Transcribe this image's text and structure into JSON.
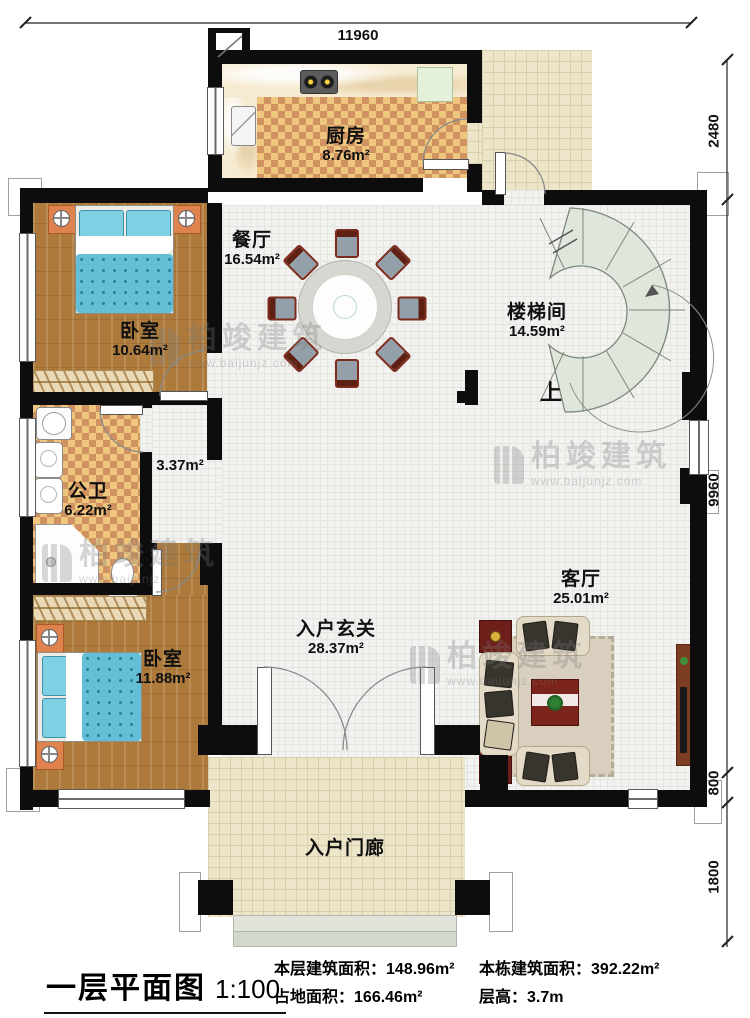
{
  "dimensions": {
    "top": "11960",
    "right": [
      {
        "label": "2480"
      },
      {
        "label": "9960"
      },
      {
        "label": "800"
      },
      {
        "label": "1800"
      }
    ]
  },
  "rooms": {
    "kitchen": {
      "name": "厨房",
      "area": "8.76m²"
    },
    "dining": {
      "name": "餐厅",
      "area": "16.54m²"
    },
    "bedroom1": {
      "name": "卧室",
      "area": "10.64m²"
    },
    "stairwell": {
      "name": "楼梯间",
      "area": "14.59m²"
    },
    "bathroom": {
      "name": "公卫",
      "area": "6.22m²"
    },
    "corridor": {
      "area": "3.37m²"
    },
    "bedroom2": {
      "name": "卧室",
      "area": "11.88m²"
    },
    "foyer": {
      "name": "入户玄关",
      "area": "28.37m²"
    },
    "living": {
      "name": "客厅",
      "area": "25.01m²"
    },
    "porch": {
      "name": "入户门廊"
    }
  },
  "stairs": {
    "up_label": "上"
  },
  "watermark": {
    "brand": "柏竣建筑",
    "url": "www.baijunjz.com"
  },
  "title_block": {
    "title": "一层平面图",
    "scale": "1:100",
    "stats": [
      {
        "label": "本层建筑面积：",
        "value": "148.96m²"
      },
      {
        "label": "占地面积：",
        "value": "166.46m²"
      },
      {
        "label": "本栋建筑面积：",
        "value": "392.22m²"
      },
      {
        "label": "层高：",
        "value": "3.7m"
      }
    ]
  }
}
